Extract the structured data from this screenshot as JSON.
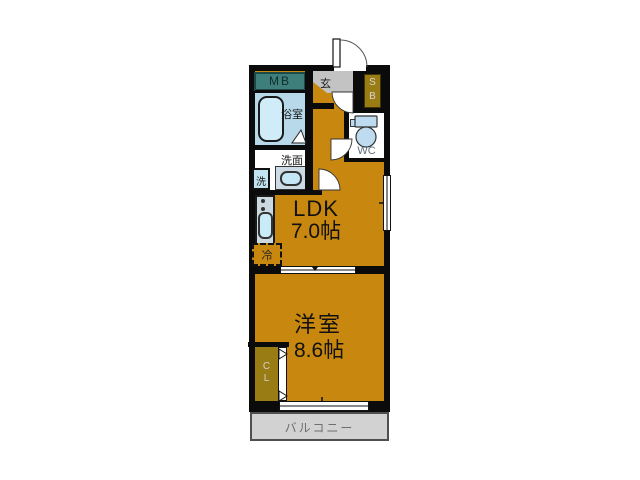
{
  "floorplan": {
    "type": "apartment-1LDK",
    "labels": {
      "mb": "MB",
      "genkan": "玄",
      "sb_top": "S",
      "sb_bottom": "B",
      "bathroom": "浴室",
      "washroom": "洗面",
      "washer": "洗",
      "wc": "WC",
      "ldk_name": "LDK",
      "ldk_size": "7.0帖",
      "fridge": "冷",
      "bedroom_name": "洋室",
      "bedroom_size": "8.6帖",
      "closet_top": "C",
      "closet_bottom": "L",
      "balcony": "バルコニー"
    },
    "colors": {
      "wall": "#0b0b0b",
      "room_fill": "#c8870e",
      "mb_fill": "#3e7f7b",
      "genkan_fill": "#c3c3c3",
      "storage_fill": "#9a7c14",
      "bathroom_fill": "#b7d9e9",
      "fixture_blue": "#c9ebf8",
      "counter_fill": "#cdd9e1",
      "balcony_fill": "#d2d2d2",
      "balcony_text": "#6e6e6e",
      "wc_text": "#5f6f7a"
    }
  }
}
